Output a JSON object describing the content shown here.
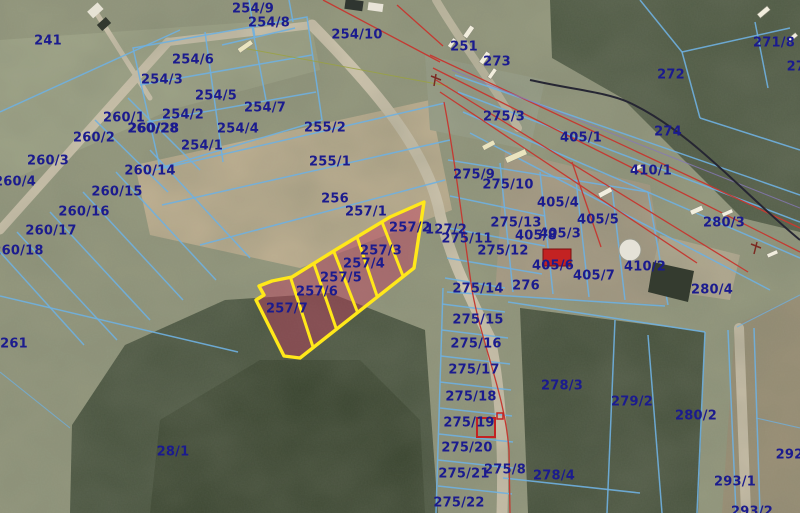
{
  "map": {
    "width": 800,
    "height": 513,
    "colors": {
      "boundary": "#6fb0e0",
      "label": "#1b1b8e",
      "highlight": "#ffe81a",
      "highfill": "#c23e5f",
      "power": "#c43a32",
      "road": "#d4c9b2",
      "forest": "#47523d",
      "field": "#95997e",
      "plowed": "#c1b192",
      "building": "#c32222",
      "dark": "#262633"
    },
    "highlighted_parcels": [
      "257/2",
      "257/3",
      "257/4",
      "257/5",
      "257/6",
      "257/7"
    ],
    "symbols": {
      "red_building_at": "405/6",
      "red_outlined_building_at": "275/19",
      "tank_near": "410/2"
    },
    "parcel_labels": [
      {
        "t": "241",
        "x": 48,
        "y": 41
      },
      {
        "t": "254/9",
        "x": 253,
        "y": 9
      },
      {
        "t": "254/8",
        "x": 269,
        "y": 23
      },
      {
        "t": "254/10",
        "x": 357,
        "y": 35
      },
      {
        "t": "254/6",
        "x": 193,
        "y": 60
      },
      {
        "t": "254/3",
        "x": 162,
        "y": 80
      },
      {
        "t": "254/5",
        "x": 216,
        "y": 96
      },
      {
        "t": "254/2",
        "x": 183,
        "y": 115
      },
      {
        "t": "254/4",
        "x": 238,
        "y": 129
      },
      {
        "t": "254/7",
        "x": 265,
        "y": 108
      },
      {
        "t": "254/1",
        "x": 202,
        "y": 146
      },
      {
        "t": "260/1",
        "x": 124,
        "y": 118
      },
      {
        "t": "260/28",
        "x": 153,
        "y": 129,
        "bold": true
      },
      {
        "t": "260/2",
        "x": 94,
        "y": 138
      },
      {
        "t": "260/3",
        "x": 48,
        "y": 161
      },
      {
        "t": "260/4",
        "x": 15,
        "y": 182
      },
      {
        "t": "260/14",
        "x": 150,
        "y": 171
      },
      {
        "t": "260/15",
        "x": 117,
        "y": 192
      },
      {
        "t": "260/16",
        "x": 84,
        "y": 212
      },
      {
        "t": "260/17",
        "x": 51,
        "y": 231
      },
      {
        "t": "260/18",
        "x": 18,
        "y": 251
      },
      {
        "t": "261",
        "x": 14,
        "y": 344
      },
      {
        "t": "28/1",
        "x": 173,
        "y": 452
      },
      {
        "t": "255/2",
        "x": 325,
        "y": 128
      },
      {
        "t": "255/1",
        "x": 330,
        "y": 162
      },
      {
        "t": "256",
        "x": 335,
        "y": 199
      },
      {
        "t": "257/1",
        "x": 366,
        "y": 212
      },
      {
        "t": "257/2",
        "x": 410,
        "y": 228
      },
      {
        "t": "127/2",
        "x": 446,
        "y": 230
      },
      {
        "t": "257/3",
        "x": 381,
        "y": 251
      },
      {
        "t": "257/4",
        "x": 364,
        "y": 264
      },
      {
        "t": "257/5",
        "x": 341,
        "y": 278
      },
      {
        "t": "257/6",
        "x": 317,
        "y": 292
      },
      {
        "t": "257/7",
        "x": 287,
        "y": 309
      },
      {
        "t": "251",
        "x": 464,
        "y": 47
      },
      {
        "t": "273",
        "x": 497,
        "y": 62
      },
      {
        "t": "275/3",
        "x": 504,
        "y": 117
      },
      {
        "t": "272",
        "x": 671,
        "y": 75
      },
      {
        "t": "271/8",
        "x": 774,
        "y": 43
      },
      {
        "t": "271/",
        "x": 803,
        "y": 67
      },
      {
        "t": "274",
        "x": 668,
        "y": 132
      },
      {
        "t": "405/1",
        "x": 581,
        "y": 138
      },
      {
        "t": "410/1",
        "x": 651,
        "y": 171
      },
      {
        "t": "280/3",
        "x": 724,
        "y": 223
      },
      {
        "t": "275/9",
        "x": 474,
        "y": 175
      },
      {
        "t": "275/10",
        "x": 508,
        "y": 185
      },
      {
        "t": "405/4",
        "x": 558,
        "y": 203
      },
      {
        "t": "405/5",
        "x": 598,
        "y": 220
      },
      {
        "t": "275/13",
        "x": 516,
        "y": 223
      },
      {
        "t": "405/8",
        "x": 536,
        "y": 236
      },
      {
        "t": "405/3",
        "x": 560,
        "y": 234
      },
      {
        "t": "275/11",
        "x": 467,
        "y": 239
      },
      {
        "t": "275/12",
        "x": 503,
        "y": 251
      },
      {
        "t": "405/6",
        "x": 553,
        "y": 266
      },
      {
        "t": "405/7",
        "x": 594,
        "y": 276
      },
      {
        "t": "276",
        "x": 526,
        "y": 286
      },
      {
        "t": "275/14",
        "x": 478,
        "y": 289
      },
      {
        "t": "410/2",
        "x": 645,
        "y": 267
      },
      {
        "t": "280/4",
        "x": 712,
        "y": 290
      },
      {
        "t": "275/15",
        "x": 478,
        "y": 320
      },
      {
        "t": "275/16",
        "x": 476,
        "y": 344
      },
      {
        "t": "275/17",
        "x": 474,
        "y": 370
      },
      {
        "t": "275/18",
        "x": 471,
        "y": 397
      },
      {
        "t": "275/19",
        "x": 469,
        "y": 423
      },
      {
        "t": "275/20",
        "x": 467,
        "y": 448
      },
      {
        "t": "275/21",
        "x": 464,
        "y": 474
      },
      {
        "t": "275/22",
        "x": 459,
        "y": 503
      },
      {
        "t": "275/8",
        "x": 505,
        "y": 470
      },
      {
        "t": "278/3",
        "x": 562,
        "y": 386
      },
      {
        "t": "278/4",
        "x": 554,
        "y": 476
      },
      {
        "t": "279/2",
        "x": 632,
        "y": 402
      },
      {
        "t": "280/2",
        "x": 696,
        "y": 416
      },
      {
        "t": "292/",
        "x": 792,
        "y": 455
      },
      {
        "t": "293/1",
        "x": 735,
        "y": 482
      },
      {
        "t": "293/2",
        "x": 752,
        "y": 512
      }
    ]
  }
}
